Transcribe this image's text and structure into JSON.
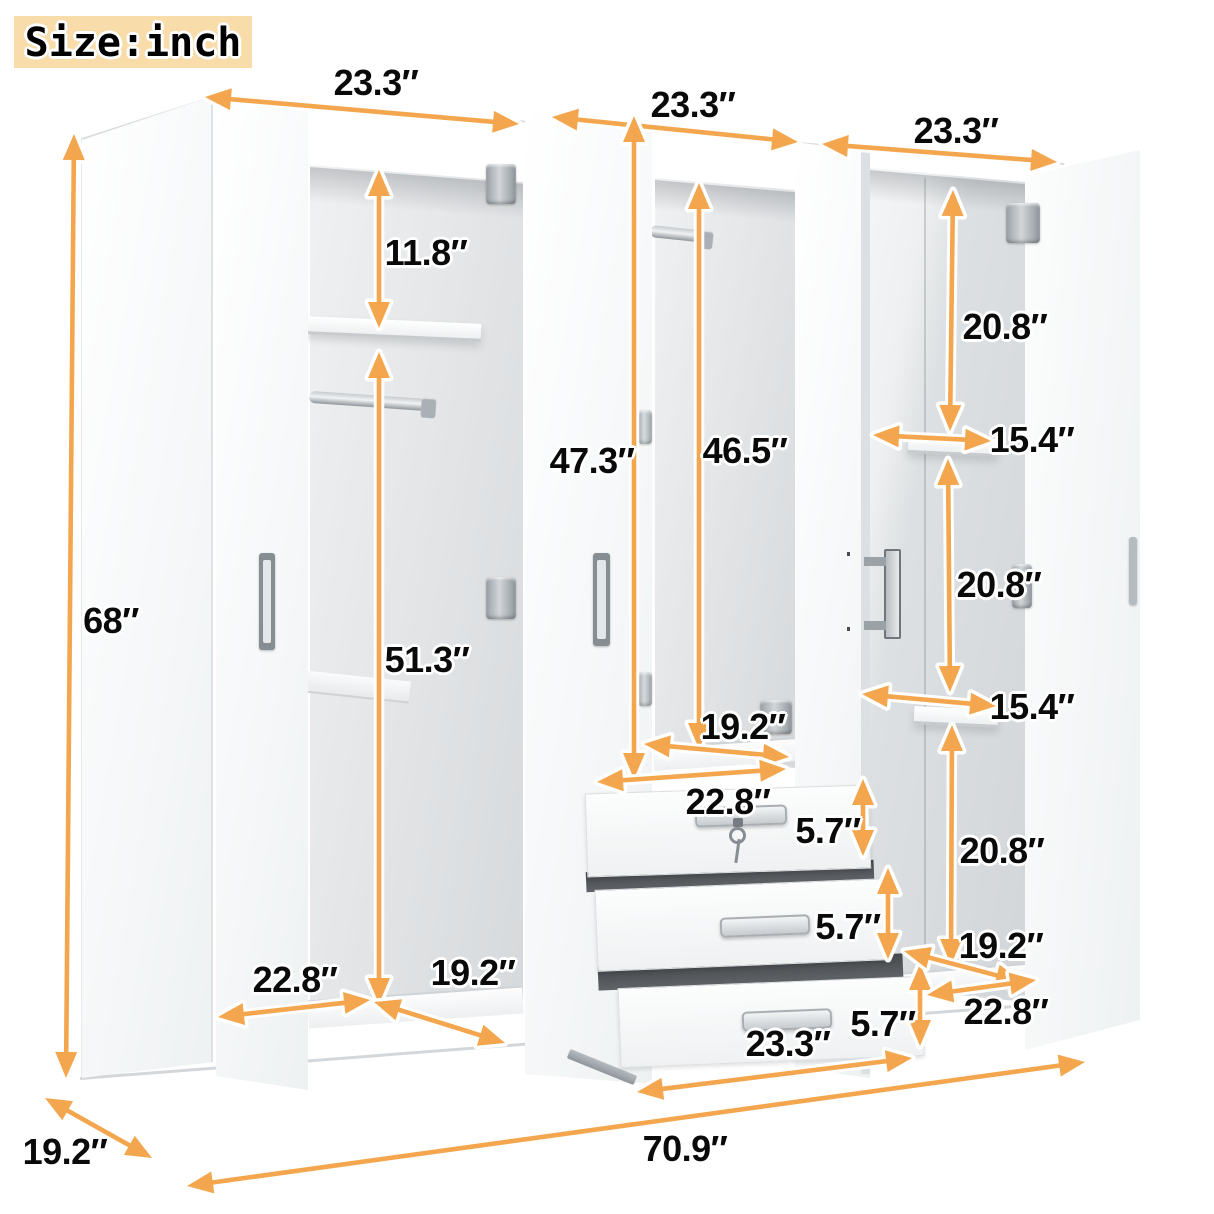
{
  "badge": {
    "text": "Size:inch"
  },
  "unit": "inch",
  "annotations": [
    {
      "id": "w1",
      "text": "23.3″"
    },
    {
      "id": "w2",
      "text": "23.3″"
    },
    {
      "id": "w3",
      "text": "23.3″"
    },
    {
      "id": "h68",
      "text": "68″"
    },
    {
      "id": "s118",
      "text": "11.8″"
    },
    {
      "id": "s513",
      "text": "51.3″"
    },
    {
      "id": "d473",
      "text": "47.3″"
    },
    {
      "id": "d465",
      "text": "46.5″"
    },
    {
      "id": "dm192",
      "text": "19.2″"
    },
    {
      "id": "dm228",
      "text": "22.8″"
    },
    {
      "id": "dr1",
      "text": "5.7″"
    },
    {
      "id": "dr2",
      "text": "5.7″"
    },
    {
      "id": "dr3",
      "text": "5.7″"
    },
    {
      "id": "dw233",
      "text": "23.3″"
    },
    {
      "id": "dl228",
      "text": "22.8″"
    },
    {
      "id": "dl192",
      "text": "19.2″"
    },
    {
      "id": "r208a",
      "text": "20.8″"
    },
    {
      "id": "r154a",
      "text": "15.4″"
    },
    {
      "id": "r208b",
      "text": "20.8″"
    },
    {
      "id": "r154b",
      "text": "15.4″"
    },
    {
      "id": "r208c",
      "text": "20.8″"
    },
    {
      "id": "r192",
      "text": "19.2″"
    },
    {
      "id": "r228",
      "text": "22.8″"
    },
    {
      "id": "depth",
      "text": "19.2″"
    },
    {
      "id": "w709",
      "text": "70.9″"
    }
  ],
  "colors": {
    "arrow": "#F3A64D",
    "badge_bg": "#F8DCAA",
    "label_text": "#0A0A0A",
    "cabinet": "#FFFFFF",
    "interior_shadow": "#D6D9DB"
  }
}
